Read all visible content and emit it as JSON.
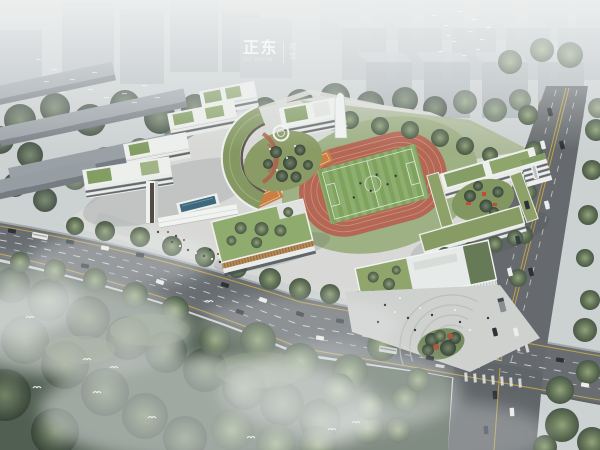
{
  "watermark": {
    "main": "正东",
    "sub": "EST VISION",
    "side_top": "视",
    "side_bottom": "觉"
  },
  "palette": {
    "haze": "#e9eded",
    "sky_base": "#cbd0d1",
    "city_block": "#b4bac0",
    "tree_dark": "#3c4a3a",
    "tree_mid": "#5d7252",
    "forest": "#49584a",
    "road": "#62676b",
    "road_marking_yellow": "#c9a83c",
    "track_red": "#b2604c",
    "field_green": "#79a056",
    "roof_green": "#7f9a5f",
    "building_white": "#eef0ed",
    "louver_wood": "#b5854e",
    "court_orange": "#c97a3a",
    "pool_blue": "#356177",
    "awning_orange": "#e89a3c"
  },
  "scene": {
    "description": "Aerial rendering of a school campus: staggered white classroom slabs with green roofs linked by a curved building, running track with football field, orange sports courts, gymnasium with corner plaza, tree-lined arterial roads with traffic, misty forest and bird flocks under a hazy city skyline"
  }
}
